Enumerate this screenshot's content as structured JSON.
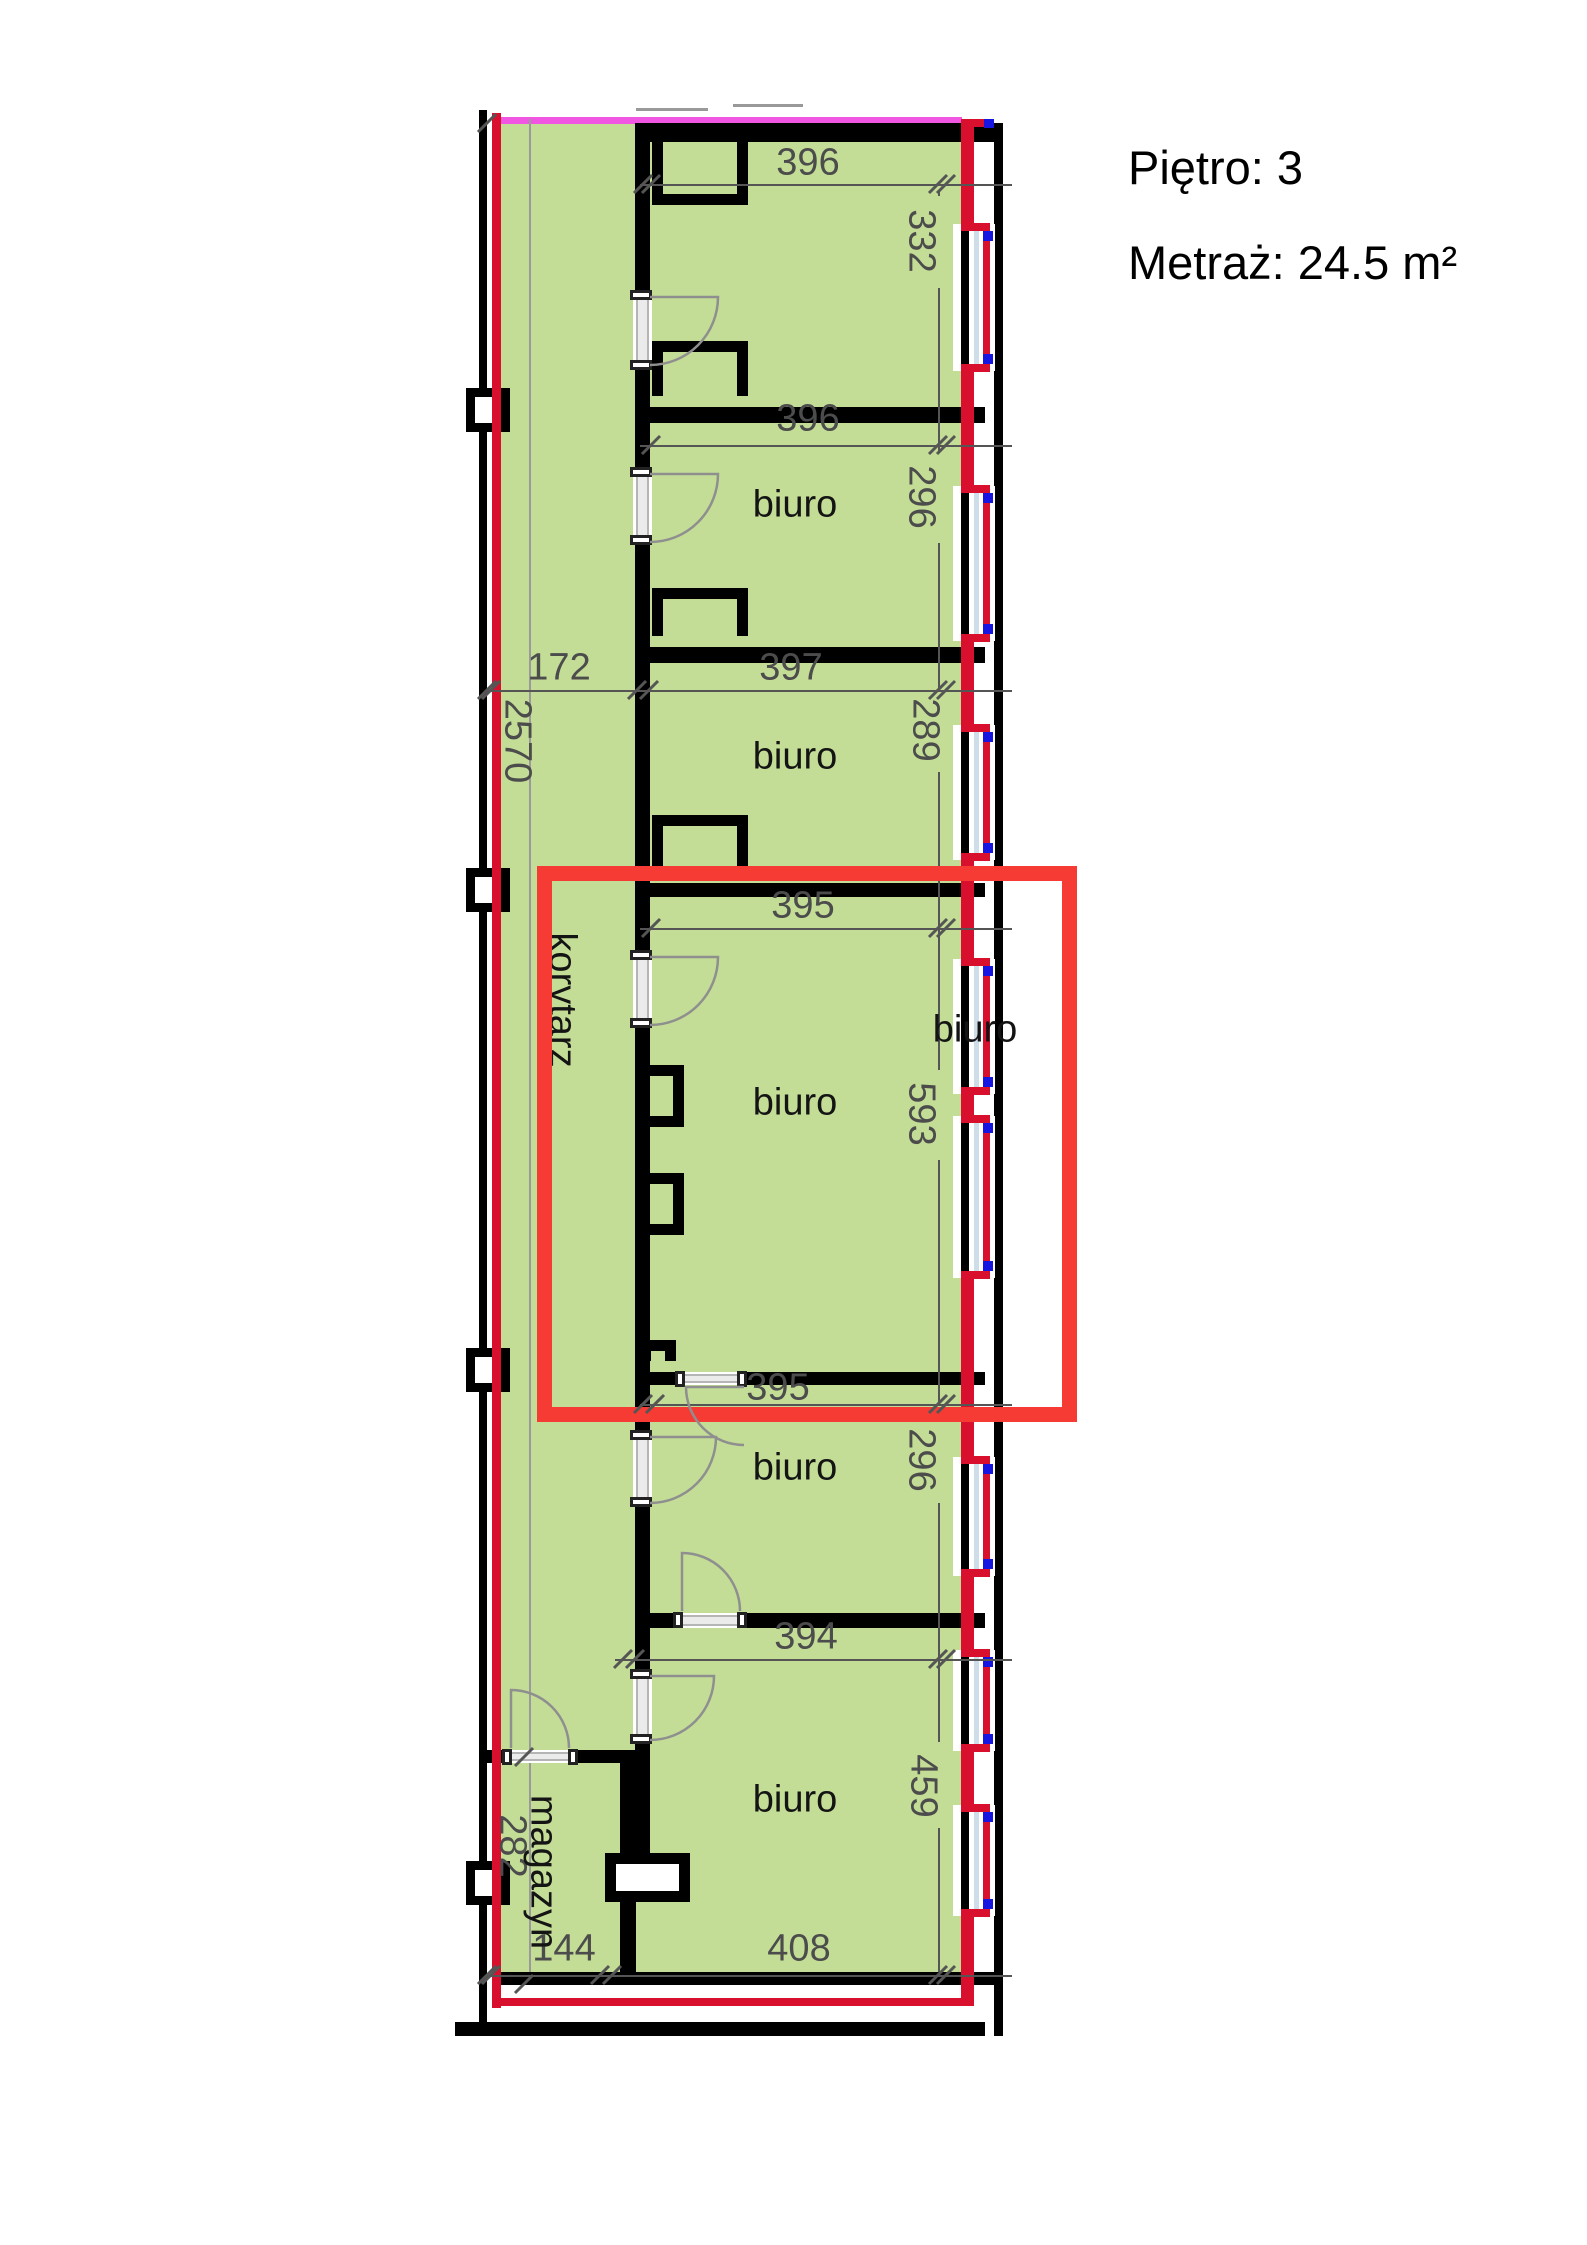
{
  "header": {
    "floor_label": "Piętro: 3",
    "area_label": "Metraż: 24.5 m²"
  },
  "colors": {
    "room_fill_green": "#c3dd96",
    "outline_red": "#d8102e",
    "highlight_red": "#f53b33",
    "top_line_magenta": "#f056e2",
    "window_blue": "#1616e0",
    "glazing_pale": "#cdddea",
    "wall_black": "#000000",
    "dim_gray": "#4c4c4c",
    "door_gray": "#ebebeb",
    "arc_gray": "#8f8f8f"
  },
  "plan": {
    "room_labels": [
      {
        "name": "room-label-biuro-1",
        "text": "biuro",
        "x": 795,
        "y": 505,
        "rot": false
      },
      {
        "name": "room-label-biuro-2",
        "text": "biuro",
        "x": 795,
        "y": 757,
        "rot": false
      },
      {
        "name": "room-label-biuro-highlighted",
        "text": "biuro",
        "x": 795,
        "y": 1103,
        "rot": false
      },
      {
        "name": "room-label-biuro-4",
        "text": "biuro",
        "x": 795,
        "y": 1468,
        "rot": false
      },
      {
        "name": "room-label-biuro-5",
        "text": "biuro",
        "x": 795,
        "y": 1800,
        "rot": false
      },
      {
        "name": "room-label-biuro-east",
        "text": "biuro",
        "x": 975,
        "y": 1030,
        "rot": false
      },
      {
        "name": "room-label-korytarz",
        "text": "korytarz",
        "x": 562,
        "y": 1000,
        "rot": true
      },
      {
        "name": "room-label-magazyn",
        "text": "magazyn",
        "x": 543,
        "y": 1872,
        "rot": true
      }
    ],
    "dim_labels": [
      {
        "name": "dim-396-room1",
        "text": "396",
        "x": 808,
        "y": 163,
        "rot": false
      },
      {
        "name": "dim-396-room2",
        "text": "396",
        "x": 808,
        "y": 419,
        "rot": false
      },
      {
        "name": "dim-172-corridor",
        "text": "172",
        "x": 559,
        "y": 668,
        "rot": false
      },
      {
        "name": "dim-397-room3",
        "text": "397",
        "x": 791,
        "y": 668,
        "rot": false
      },
      {
        "name": "dim-395-room4-top",
        "text": "395",
        "x": 803,
        "y": 906,
        "rot": false
      },
      {
        "name": "dim-395-room4-bottom",
        "text": "395",
        "x": 778,
        "y": 1388,
        "rot": false
      },
      {
        "name": "dim-394-room5",
        "text": "394",
        "x": 806,
        "y": 1637,
        "rot": false
      },
      {
        "name": "dim-144-magazyn",
        "text": "144",
        "x": 564,
        "y": 1949,
        "rot": false
      },
      {
        "name": "dim-408-room6",
        "text": "408",
        "x": 799,
        "y": 1949,
        "rot": false
      },
      {
        "name": "dim-332-room1",
        "text": "332",
        "x": 921,
        "y": 241,
        "rot": true
      },
      {
        "name": "dim-296-room2",
        "text": "296",
        "x": 921,
        "y": 497,
        "rot": true
      },
      {
        "name": "dim-289-room3",
        "text": "289",
        "x": 925,
        "y": 730,
        "rot": true
      },
      {
        "name": "dim-2570-corridor",
        "text": "2570",
        "x": 517,
        "y": 741,
        "rot": true
      },
      {
        "name": "dim-593-room4",
        "text": "593",
        "x": 921,
        "y": 1114,
        "rot": true
      },
      {
        "name": "dim-296-room5",
        "text": "296",
        "x": 921,
        "y": 1460,
        "rot": true
      },
      {
        "name": "dim-459-room6",
        "text": "459",
        "x": 923,
        "y": 1786,
        "rot": true
      },
      {
        "name": "dim-282-magazyn",
        "text": "282",
        "x": 512,
        "y": 1846,
        "rot": true
      }
    ],
    "base_rects": [
      {
        "name": "floor-area-green",
        "x": 501,
        "y": 119,
        "w": 461,
        "h": 1866,
        "bg": "#c3dd96"
      },
      {
        "name": "top-boundary-magenta",
        "x": 494,
        "y": 117,
        "w": 468,
        "h": 7,
        "bg": "#f056e2"
      },
      {
        "name": "extension-line-corridor",
        "x": 529,
        "y": 119,
        "w": 2,
        "h": 1858,
        "bg": "#9a9a9a"
      },
      {
        "name": "window-sill-mark",
        "x": 636,
        "y": 108,
        "w": 72,
        "h": 3,
        "bg": "#999999"
      },
      {
        "name": "window-sill-mark",
        "x": 733,
        "y": 104,
        "w": 70,
        "h": 3,
        "bg": "#999999"
      },
      {
        "name": "wall-outer-left",
        "x": 479,
        "y": 110,
        "w": 8,
        "h": 1926,
        "bg": "#000000"
      },
      {
        "name": "wall-outer-top",
        "x": 650,
        "y": 123,
        "w": 353,
        "h": 19,
        "bg": "#000000"
      },
      {
        "name": "wall-outer-right",
        "x": 994,
        "y": 123,
        "w": 9,
        "h": 1913,
        "bg": "#000000"
      },
      {
        "name": "wall-partition-corridor",
        "x": 635,
        "y": 123,
        "w": 15,
        "h": 1735,
        "bg": "#000000"
      },
      {
        "name": "wall-divider-room1-2",
        "x": 650,
        "y": 407,
        "w": 335,
        "h": 16,
        "bg": "#000000"
      },
      {
        "name": "wall-divider-room2-3",
        "x": 650,
        "y": 647,
        "w": 335,
        "h": 16,
        "bg": "#000000"
      },
      {
        "name": "wall-divider-room3-4",
        "x": 650,
        "y": 883,
        "w": 335,
        "h": 14,
        "bg": "#000000"
      },
      {
        "name": "wall-divider-room4-5",
        "x": 650,
        "y": 1372,
        "w": 335,
        "h": 13,
        "bg": "#000000"
      },
      {
        "name": "wall-divider-room5-6",
        "x": 650,
        "y": 1613,
        "w": 335,
        "h": 15,
        "bg": "#000000"
      },
      {
        "name": "wall-magazyn-top",
        "x": 487,
        "y": 1750,
        "w": 149,
        "h": 13,
        "bg": "#000000"
      },
      {
        "name": "wall-magazyn-right",
        "x": 620,
        "y": 1750,
        "w": 16,
        "h": 235,
        "bg": "#000000"
      },
      {
        "name": "wall-outer-bottom",
        "x": 501,
        "y": 1972,
        "w": 502,
        "h": 13,
        "bg": "#000000"
      },
      {
        "name": "ground-line",
        "x": 455,
        "y": 2022,
        "w": 530,
        "h": 14,
        "bg": "#000000"
      }
    ],
    "red_right_segments": [
      [
        119,
        231
      ],
      [
        364,
        493
      ],
      [
        634,
        732
      ],
      [
        853,
        966
      ],
      [
        1087,
        1123
      ],
      [
        1271,
        1464
      ],
      [
        1569,
        1657
      ],
      [
        1744,
        1812
      ],
      [
        1909,
        2006
      ]
    ],
    "red_right_x": 961,
    "red_right_w": 13,
    "red_misc": [
      {
        "name": "red-jog-top",
        "x": 961,
        "y": 119,
        "w": 31,
        "h": 8,
        "bg": "#d8102e"
      },
      {
        "name": "window-blue-mark",
        "x": 984,
        "y": 119,
        "w": 10,
        "h": 9,
        "bg": "#1616e0"
      }
    ],
    "windows": [
      [
        227,
        368
      ],
      [
        489,
        638
      ],
      [
        728,
        857
      ],
      [
        962,
        1091
      ],
      [
        1119,
        1275
      ],
      [
        1460,
        1573
      ],
      [
        1653,
        1748
      ],
      [
        1808,
        1913
      ]
    ],
    "markers_y": [
      410,
      890,
      1370,
      1883
    ],
    "red_left": {
      "name": "red-outline-left",
      "x": 492,
      "y": 113,
      "w": 9,
      "h": 1895,
      "bg": "#d8102e"
    },
    "red_bottom": {
      "name": "red-outline-bottom",
      "x": 492,
      "y": 1998,
      "w": 481,
      "h": 8,
      "bg": "#d8102e"
    },
    "notches": [
      {
        "x": 652,
        "y": 142,
        "w": 96,
        "h": 74,
        "open": "top"
      },
      {
        "x": 652,
        "y": 341,
        "w": 96,
        "h": 66,
        "open": "bottom"
      },
      {
        "x": 652,
        "y": 588,
        "w": 96,
        "h": 59,
        "open": "bottom"
      },
      {
        "x": 652,
        "y": 815,
        "w": 96,
        "h": 68,
        "open": "bottom"
      },
      {
        "x": 650,
        "y": 1065,
        "w": 45,
        "h": 62,
        "open": "left"
      },
      {
        "x": 650,
        "y": 1173,
        "w": 45,
        "h": 62,
        "open": "left"
      },
      {
        "x": 640,
        "y": 1340,
        "w": 36,
        "h": 32,
        "open": "bottom"
      },
      {
        "x": 605,
        "y": 1853,
        "w": 85,
        "h": 49,
        "open": "none"
      }
    ],
    "dim_lines_h": [
      {
        "x1": 640,
        "x2": 1012,
        "y": 184
      },
      {
        "x1": 640,
        "x2": 1012,
        "y": 445
      },
      {
        "x1": 487,
        "x2": 1012,
        "y": 690
      },
      {
        "x1": 640,
        "x2": 1012,
        "y": 928
      },
      {
        "x1": 640,
        "x2": 1012,
        "y": 1404
      },
      {
        "x1": 615,
        "x2": 1012,
        "y": 1659
      },
      {
        "x1": 487,
        "x2": 1012,
        "y": 1975
      }
    ],
    "dim_line_v": {
      "x": 938,
      "segments": [
        [
          190,
          196
        ],
        [
          288,
          452
        ],
        [
          543,
          691
        ],
        [
          772,
          1070
        ],
        [
          1160,
          1402
        ],
        [
          1503,
          1742
        ],
        [
          1828,
          1972
        ]
      ]
    },
    "ticks": [
      [
        651,
        184
      ],
      [
        946,
        184
      ],
      [
        643,
        184
      ],
      [
        651,
        445
      ],
      [
        946,
        445
      ],
      [
        491,
        690
      ],
      [
        637,
        690
      ],
      [
        649,
        690
      ],
      [
        946,
        690
      ],
      [
        651,
        928
      ],
      [
        946,
        928
      ],
      [
        643,
        1404
      ],
      [
        655,
        1404
      ],
      [
        946,
        1404
      ],
      [
        623,
        1659
      ],
      [
        635,
        1659
      ],
      [
        946,
        1659
      ],
      [
        491,
        1975
      ],
      [
        600,
        1975
      ],
      [
        612,
        1975
      ],
      [
        946,
        1975
      ],
      [
        938,
        184
      ],
      [
        938,
        445
      ],
      [
        938,
        690
      ],
      [
        938,
        928
      ],
      [
        938,
        1404
      ],
      [
        938,
        1659
      ],
      [
        938,
        1975
      ],
      [
        487,
        123
      ],
      [
        487,
        690
      ],
      [
        487,
        1975
      ],
      [
        524,
        1757
      ],
      [
        524,
        1984
      ]
    ],
    "doors_v": [
      {
        "y1": 295,
        "y2": 365
      },
      {
        "y1": 472,
        "y2": 540
      },
      {
        "y1": 955,
        "y2": 1023
      },
      {
        "y1": 1435,
        "y2": 1502
      },
      {
        "y1": 1674,
        "y2": 1739
      }
    ],
    "doors_h": [
      {
        "x1": 680,
        "x2": 742,
        "y": 1372,
        "h": 13
      },
      {
        "x1": 678,
        "x2": 742,
        "y": 1613,
        "h": 15
      },
      {
        "x1": 507,
        "x2": 573,
        "y": 1750,
        "h": 13
      }
    ],
    "arcs": [
      "M650,297 L718,297 A68,68 0 0 1 650,365",
      "M650,474 L718,474 A68,68 0 0 1 650,542",
      "M650,957 L718,957 A68,68 0 0 1 650,1025",
      "M650,1437 L716,1437 A66,66 0 0 1 650,1503",
      "M650,1676 L714,1676 A64,64 0 0 1 650,1740",
      "M744,1387 L686,1387 A58,58 0 0 0 744,1445",
      "M682,1611 L682,1553 A58,58 0 0 1 740,1611",
      "M511,1748 L511,1690 A58,58 0 0 1 569,1748"
    ],
    "highlight_box": {
      "name": "highlight-rectangle",
      "x": 537,
      "y": 866,
      "w": 540,
      "h": 556,
      "stroke": 15
    }
  }
}
